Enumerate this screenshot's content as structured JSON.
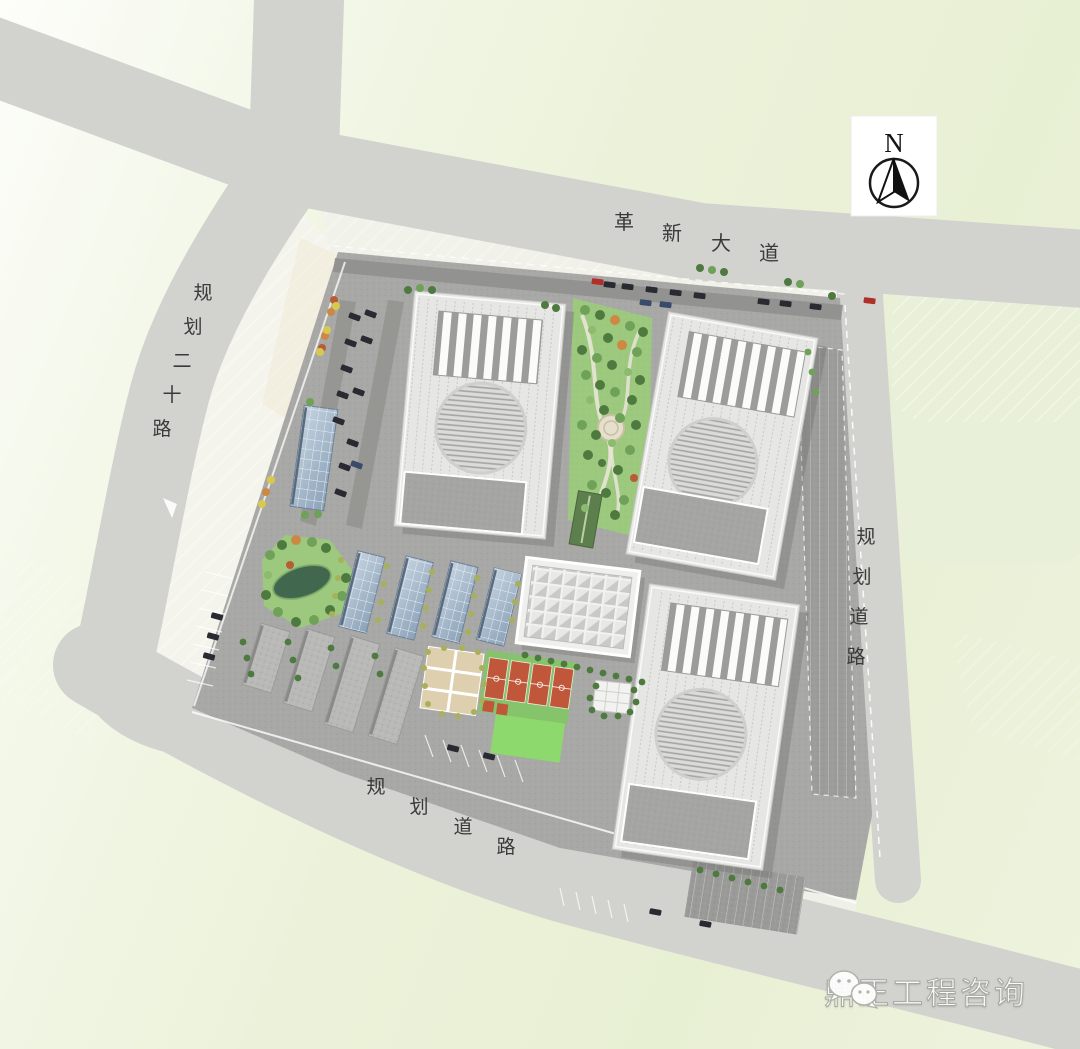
{
  "compass": {
    "label": "N"
  },
  "roads": {
    "north": {
      "name": "革新大道",
      "chars": [
        "革",
        "新",
        "大",
        "道"
      ]
    },
    "west": {
      "name": "规划二十路",
      "chars": [
        "规",
        "划",
        "二",
        "十",
        "路"
      ]
    },
    "east": {
      "name": "规划道路",
      "chars": [
        "规",
        "划",
        "道",
        "路"
      ]
    },
    "south": {
      "name": "规划道路",
      "chars": [
        "规",
        "划",
        "道",
        "路"
      ]
    }
  },
  "watermark": {
    "brand": "鼎正工程咨询",
    "icon": "wechat-icon"
  },
  "colors": {
    "background_green": "#eef3de",
    "road_gray": "#d2d2cf",
    "sidewalk_white": "#f1f1ea",
    "parcel_gray": "#a8a8a6",
    "roof_white": "#e6e6e4",
    "dock_gray": "#a5a5a3",
    "solar_blue": "#9db3c9",
    "park_green": "#9cc97e",
    "pond_green": "#41684f",
    "court_red": "#c0563a",
    "court_tan": "#decfae",
    "lawn_green": "#8ade68",
    "label_text": "#3a3a3a"
  }
}
